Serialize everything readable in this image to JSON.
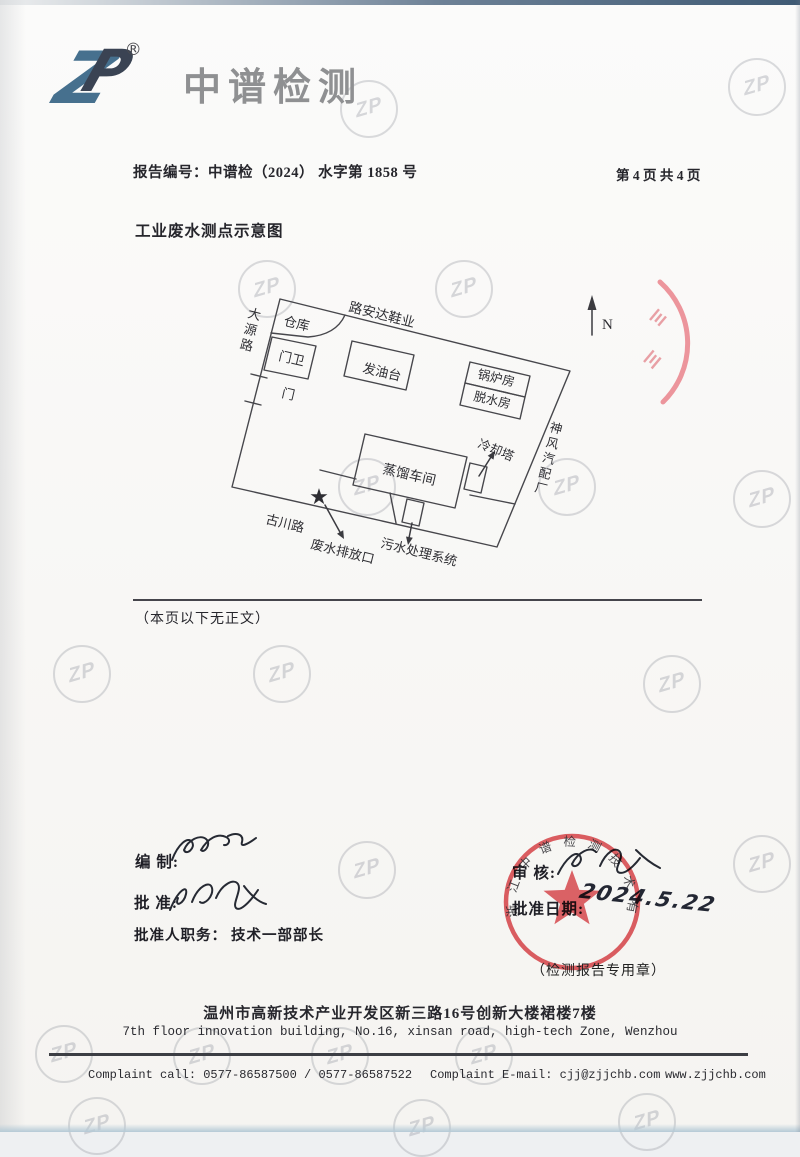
{
  "header": {
    "logo": {
      "z": "Z",
      "p": "P",
      "registered": "®",
      "brand": "中谱检测"
    },
    "report_no": "报告编号：中谱检（2024） 水字第 1858 号",
    "page_info": "第 4 页 共 4 页"
  },
  "title": "工业废水测点示意图",
  "diagram": {
    "north_label": "N",
    "sampling_point_marker": "★",
    "labels": {
      "road_top": "路安达鞋业",
      "road_left": "大源路",
      "road_bottom": "古川路",
      "neighbor_right": "神风汽配厂",
      "warehouse": "仓库",
      "gatehouse": "门卫",
      "gate": "门",
      "oil_platform": "发油台",
      "boiler_room": "锅炉房",
      "dewatering_room": "脱水房",
      "distillation_workshop": "蒸馏车间",
      "cooling_tower": "冷却塔",
      "sewage_treatment": "污水处理系统",
      "discharge_outlet": "废水排放口"
    }
  },
  "note": "（本页以下无正文）",
  "signoff": {
    "prepared_label": "编 制:",
    "approved_label": "批 准:",
    "approver_title_label": "批准人职务：",
    "approver_title_value": "技术一部部长",
    "reviewed_label": "审 核:",
    "date_label": "批准日期:",
    "date_value": "2024.5.22",
    "seal_ring_text": "浙江中谱检测技术有限公司",
    "seal_caption": "（检测报告专用章）"
  },
  "footer": {
    "address_cn": "温州市高新技术产业开发区新三路16号创新大楼裙楼7楼",
    "address_en": "7th floor innovation building, No.16, xinsan road, high-tech Zone, Wenzhou",
    "complaint_call": "Complaint call: 0577-86587500 / 0577-86587522",
    "complaint_email": "Complaint E-mail: cjj@zjjchb.com",
    "website": "www.zjjchb.com"
  },
  "watermark": {
    "monogram": "ZP"
  },
  "colors": {
    "seal_red": "#dd4a50",
    "logo_blue": "#46708e",
    "logo_dark": "#3a4353",
    "brand_gray": "#8f9092"
  }
}
